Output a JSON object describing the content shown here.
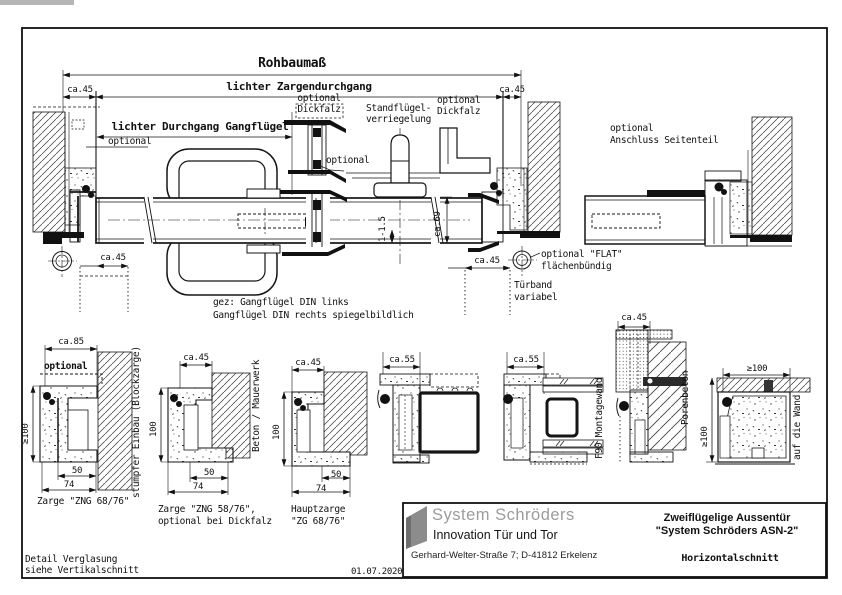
{
  "page": {
    "frame_note_line1": "Detail Verglasung",
    "frame_note_line2": "siehe Vertikalschnitt",
    "date": "01.07.2020"
  },
  "main_view": {
    "dim_rohbaumass": "Rohbaumaß",
    "dim_zargendurchgang": "lichter Zargendurchgang",
    "dim_gangfluegel": "lichter Durchgang Gangflügel",
    "dim_ca45_top_left": "ca.45",
    "dim_ca45_top_right": "ca.45",
    "dim_ca45_hinge_left": "ca.45",
    "dim_ca45_hinge_right": "ca.45",
    "dim_ca69": "ca.69",
    "dim_gap": "1-1.5",
    "label_optional_left": "optional",
    "label_optional_mid": "optional",
    "label_dickfalz_mid_1": "optional",
    "label_dickfalz_mid_2": "Dickfalz",
    "label_standfluegel_1": "Standflügel-",
    "label_standfluegel_2": "verriegelung",
    "label_dickfalz_right_1": "optional",
    "label_dickfalz_right_2": "Dickfalz",
    "label_seitenteil_1": "optional",
    "label_seitenteil_2": "Anschluss Seitenteil",
    "label_flat_1": "optional \"FLAT\"",
    "label_flat_2": "flächenbündig",
    "label_tuerband_1": "Türband",
    "label_tuerband_2": "variabel",
    "note_gez_1": "gez: Gangflügel DIN links",
    "note_gez_2": "Gangflügel DIN rechts spiegelbildlich"
  },
  "sections": [
    {
      "top_dim": "ca.85",
      "left_dim": "≥100",
      "dim_rebate": "50",
      "dim_total": "74",
      "caption_1": "Zarge \"ZNG 68/76\"",
      "side_label": "stumpfer Einbau (Blockzarge)",
      "extra_label": "optional"
    },
    {
      "top_dim": "ca.45",
      "left_dim": "100",
      "dim_rebate": "50",
      "dim_total": "74",
      "caption_1": "Zarge \"ZNG 58/76\",",
      "caption_2": "optional bei Dickfalz",
      "side_label": "Beton / Mauerwerk"
    },
    {
      "top_dim": "ca.45",
      "left_dim": "100",
      "dim_rebate": "50",
      "dim_total": "74",
      "caption_1": "Hauptzarge",
      "caption_2": "\"ZG 68/76\""
    },
    {
      "top_dim": "ca.55"
    },
    {
      "top_dim": "ca.55",
      "side_label": "F90 Montagewand"
    },
    {
      "top_dim": "ca.45",
      "side_label": "Porenbeton"
    },
    {
      "top_dim": "≥100",
      "left_dim": "≥100",
      "side_label": "auf die Wand"
    }
  ],
  "title_block": {
    "company": "System Schröders",
    "tagline": "Innovation Tür und Tor",
    "address": "Gerhard-Welter-Straße 7;  D-41812 Erkelenz",
    "drawing_title_1": "Zweiflügelige Aussentür",
    "drawing_title_2": "\"System Schröders ASN-2\"",
    "drawing_subtitle": "Horizontalschnitt"
  }
}
